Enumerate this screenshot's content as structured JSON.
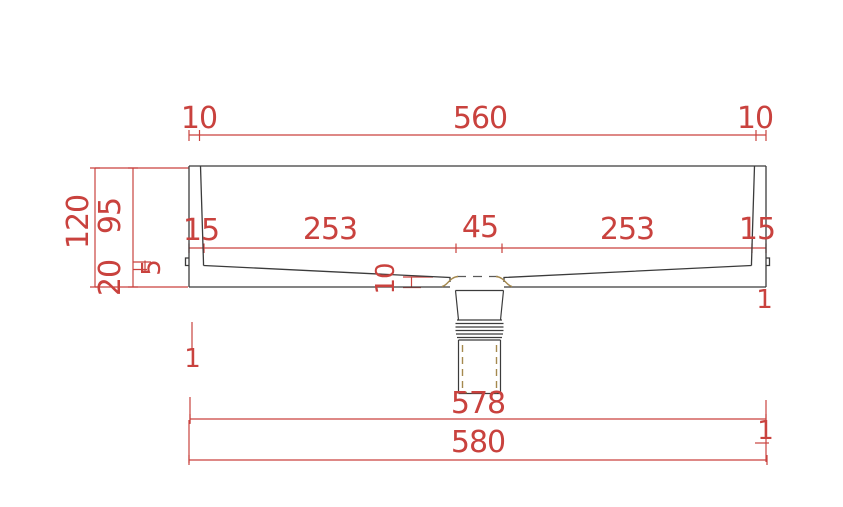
{
  "drawing": {
    "description": "CAD cross-section drawing of a rectangular wash basin with center drain, fully dimensioned",
    "units": "mm",
    "colors": {
      "dimension_red": "#c9423e",
      "outline_black": "#3b3b3b",
      "hidden_olive": "#a5894e",
      "background": "#ffffff"
    },
    "dimensions": {
      "top_row": {
        "left_offset": "10",
        "inner_width": "560",
        "right_offset": "10"
      },
      "left_column": {
        "overall_height": "120",
        "basin_depth": "95",
        "base_thickness": "20",
        "step": "5"
      },
      "middle_row": {
        "left_wall": "15",
        "left_floor_run": "253",
        "drain_width": "45",
        "right_floor_run": "253",
        "right_wall": "15"
      },
      "floor_thickness": "10",
      "bottom_row": {
        "inner_length": "578",
        "overall_length": "580"
      },
      "edge_marks": {
        "left_lower": "1",
        "right_lower": "1",
        "right_mid": "1"
      }
    }
  }
}
